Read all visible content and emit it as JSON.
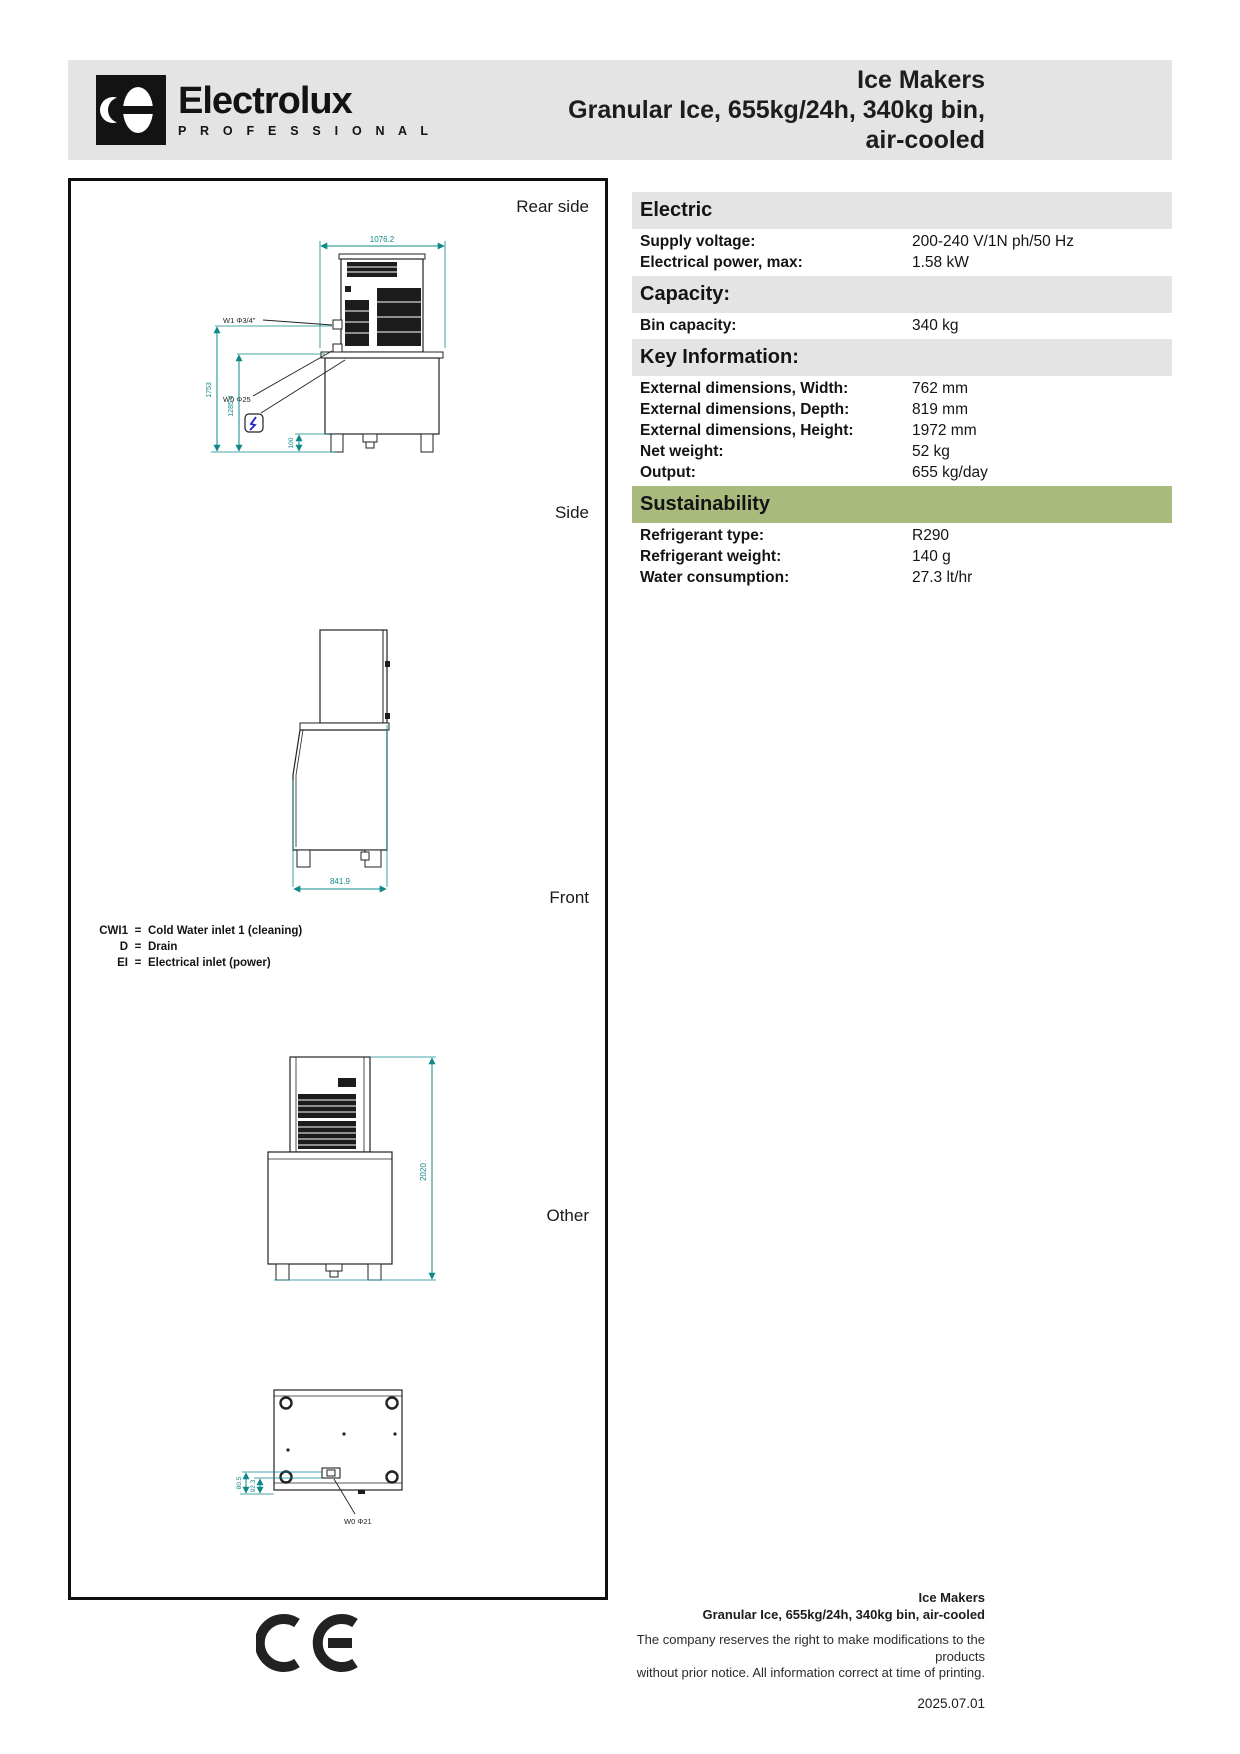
{
  "header": {
    "brand": "Electrolux",
    "brand_sub": "P R O F E S S I O N A L",
    "title_line1": "Ice Makers",
    "title_line2": "Granular Ice, 655kg/24h, 340kg bin,",
    "title_line3": "air-cooled"
  },
  "views": {
    "rear": "Rear side",
    "side": "Side",
    "front": "Front",
    "other": "Other"
  },
  "dims": {
    "rear_width": "1076.2",
    "rear_height_total": "1753",
    "rear_height_bin": "1285.4",
    "rear_leg": "100",
    "rear_w1": "W1 Φ3/4\"",
    "rear_w0": "W0 Φ25",
    "side_depth": "841.9",
    "front_height": "2020",
    "other_dim_a": "80.5",
    "other_dim_b": "92.3",
    "other_w0": "W0 Φ21"
  },
  "legend": [
    {
      "abbr": "CWI1",
      "eq": "=",
      "desc": "Cold Water inlet 1 (cleaning)"
    },
    {
      "abbr": "D",
      "eq": "=",
      "desc": "Drain"
    },
    {
      "abbr": "EI",
      "eq": "=",
      "desc": "Electrical inlet (power)"
    }
  ],
  "specs": {
    "sections": [
      {
        "heading": "Electric",
        "rows": [
          {
            "label": "Supply voltage:",
            "value": "200-240 V/1N ph/50 Hz"
          },
          {
            "label": "Electrical power, max:",
            "value": "1.58 kW"
          }
        ]
      },
      {
        "heading": "Capacity:",
        "rows": [
          {
            "label": "Bin capacity:",
            "value": "340 kg"
          }
        ]
      },
      {
        "heading": "Key Information:",
        "rows": [
          {
            "label": "External dimensions, Width:",
            "value": "762 mm"
          },
          {
            "label": "External dimensions, Depth:",
            "value": "819 mm"
          },
          {
            "label": "External dimensions, Height:",
            "value": "1972 mm"
          },
          {
            "label": "Net weight:",
            "value": "52 kg"
          },
          {
            "label": "Output:",
            "value": "655 kg/day"
          }
        ]
      },
      {
        "heading": "Sustainability",
        "rows": [
          {
            "label": "Refrigerant type:",
            "value": "R290"
          },
          {
            "label": "Refrigerant weight:",
            "value": "140 g"
          },
          {
            "label": "Water consumption:",
            "value": "27.3 lt/hr"
          }
        ]
      }
    ]
  },
  "footer": {
    "line1": "Ice Makers",
    "line2": "Granular Ice, 655kg/24h, 340kg bin, air-cooled",
    "line3": "The company reserves the right to make modifications to the products",
    "line4": "without prior notice. All information correct at time of printing.",
    "date": "2025.07.01"
  },
  "colors": {
    "band_gray": "#e4e4e4",
    "sustainability_green": "#a9ba7d",
    "dimension_teal": "#0e8888",
    "bolt_blue": "#2323cc"
  }
}
